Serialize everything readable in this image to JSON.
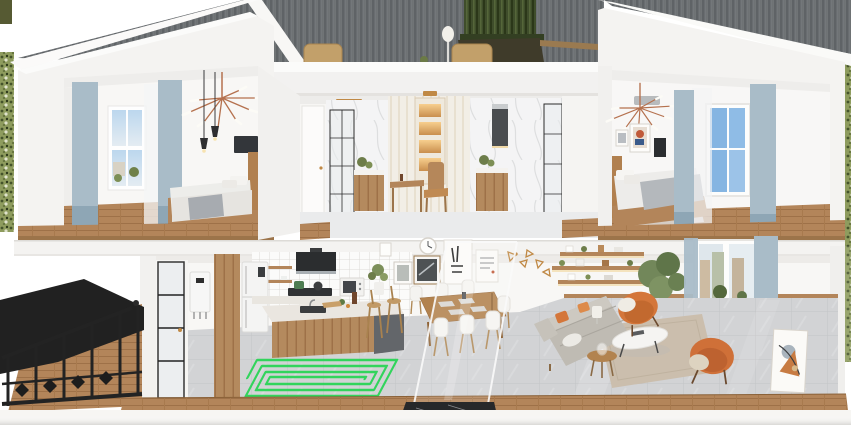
{
  "scene": {
    "type": "3d-cutaway-dollhouse-render",
    "description": "Photorealistic cross-section rendering of a two-storey home: bedrooms and bathrooms upstairs with a roof terrace, open-plan kitchen, dining and living room downstairs, black outdoor staircase at lower left, and a green underfloor-heating coil highlighted on the kitchen floor",
    "floors": [
      "upper floor",
      "ground floor"
    ]
  },
  "highlight": {
    "name": "underfloor heating pipe coil",
    "shape": "rectangular spiral, about 5 concentric loops",
    "location": "ground-floor kitchen tiles",
    "color": "#29d455"
  },
  "upper_floor": {
    "bedroom_left": {
      "label": "left bedroom",
      "items": [
        "blue-grey curtains",
        "sheer curtain",
        "street-view window",
        "copper branch chandelier",
        "two black pendant lamps",
        "wall-mounted tv",
        "wooden bed with grey bedding",
        "dark blue rug",
        "oak plank floor"
      ]
    },
    "roof_terrace": {
      "label": "roof terrace",
      "items": [
        "two rattan lounge chairs",
        "white table lamp",
        "long planter with tall hedge",
        "grey standing-seam roof cladding"
      ]
    },
    "bathroom_left": {
      "label": "left bathroom",
      "items": [
        "white door",
        "black-framed glass shower",
        "marble tiled walls",
        "wooden vanity with plant"
      ]
    },
    "dressing_nook": {
      "label": "central dressing nook",
      "items": [
        "panelled wall with brass trim",
        "cabinet with four lit niches",
        "wooden desk",
        "wooden chair",
        "brass ceiling light"
      ]
    },
    "bathroom_right": {
      "label": "right bathroom",
      "items": [
        "marble tiled walls",
        "dark mirror cabinet",
        "wooden vanity with plant",
        "black-framed glass door"
      ]
    },
    "bedroom_right": {
      "label": "right bedroom",
      "items": [
        "copper branch chandelier",
        "two gallery frames",
        "black wall panel",
        "wooden bed with grey blanket",
        "sky-blue window",
        "blue-grey curtains",
        "light rug",
        "oak plank floor"
      ]
    }
  },
  "ground_floor": {
    "entry": {
      "label": "entry",
      "items": [
        "black-framed glass door",
        "wall-hung boiler",
        "tall wooden cabinet",
        "white two-door fridge"
      ]
    },
    "kitchen": {
      "label": "kitchen",
      "items": [
        "white grid-tile backsplash",
        "open wooden shelves",
        "black range hood",
        "cooktop with pots",
        "counter-top oven",
        "marble-top island with sink",
        "two wooden bar stools",
        "potted plant"
      ]
    },
    "dining": {
      "label": "dining area",
      "items": [
        "gallery wall with five frames",
        "round wall clock",
        "brass triangle wall decor",
        "wooden dining table with placemats",
        "six white shell chairs",
        "glass partition with black marble base"
      ]
    },
    "living": {
      "label": "living room",
      "items": [
        "floating wood shelves with decor",
        "potted tree",
        "street-view window with blue-grey curtains",
        "grey fabric sofa with orange cushions",
        "white oval coffee table",
        "round wooden side table",
        "two orange armchairs with throws",
        "beige area rug",
        "leaning abstract artwork",
        "stack of books"
      ]
    }
  },
  "exterior": {
    "staircase": {
      "label": "black outdoor staircase",
      "items": [
        "black metal railing",
        "dark canopy",
        "wooden deck floor"
      ]
    },
    "landscape": {
      "label": "foliage strips at left and right edges"
    }
  },
  "palette": {
    "wall-white": "#f4f3f1",
    "roof-grey": "#6f7376",
    "wood": "#b3855a",
    "wood-dark": "#9c744a",
    "curtain-blue": "#a9bcc8",
    "curtain-blue-dark": "#8ea6b5",
    "coil-green": "#29d455",
    "hedge-green": "#3f4d2b",
    "accent-orange": "#d4763a",
    "sofa-grey": "#bfbbb3",
    "tile-grey": "#d2d3d5",
    "frame-black": "#27282a",
    "brass": "#c08945"
  }
}
